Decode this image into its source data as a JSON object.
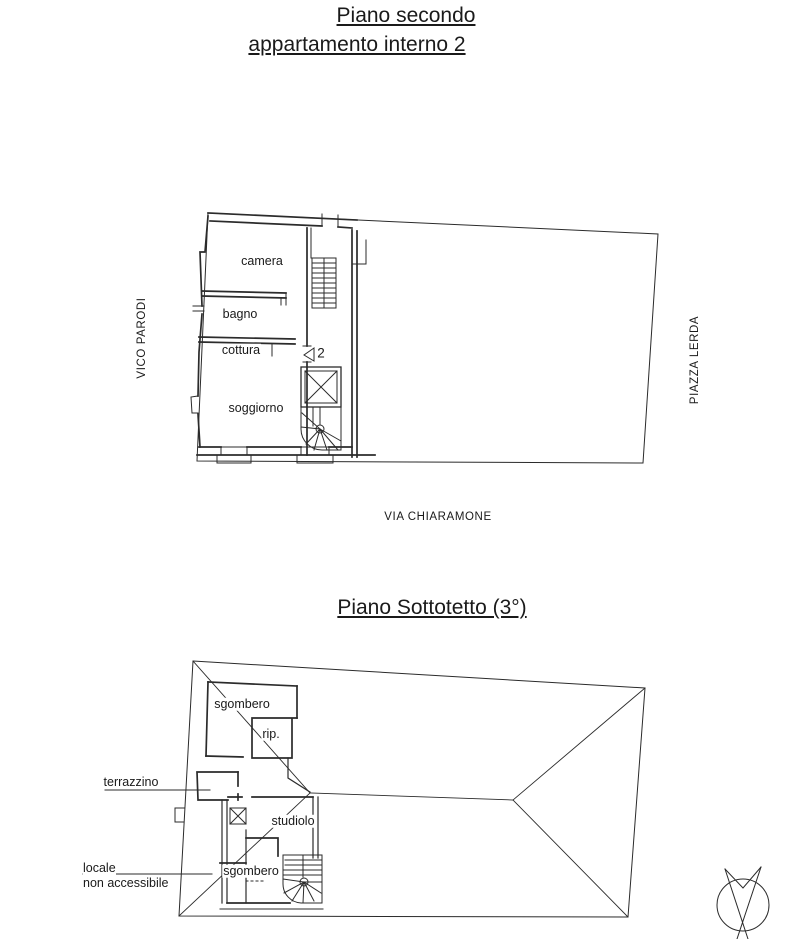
{
  "upper_plan": {
    "title_line1": "Piano secondo",
    "title_line2": "appartamento interno 2",
    "room_camera": "camera",
    "room_bagno": "bagno",
    "room_cottura": "cottura",
    "room_soggiorno": "soggiorno",
    "unit_number": "2",
    "street_left": "VICO PARODI",
    "street_right": "PIAZZA LERDA",
    "street_bottom": "VIA CHIARAMONE"
  },
  "lower_plan": {
    "title": "Piano Sottotetto (3°)",
    "room_sgombero_top": "sgombero",
    "room_rip": "rip.",
    "room_terrazzino": "terrazzino",
    "room_studiolo": "studiolo",
    "room_locale_line1": "locale",
    "room_locale_line2": "non accessibile",
    "room_sgombero_bottom": "sgombero"
  },
  "icons": {
    "compass": "north-arrow"
  },
  "colors": {
    "line": "#2b2b2b",
    "background": "#ffffff"
  }
}
